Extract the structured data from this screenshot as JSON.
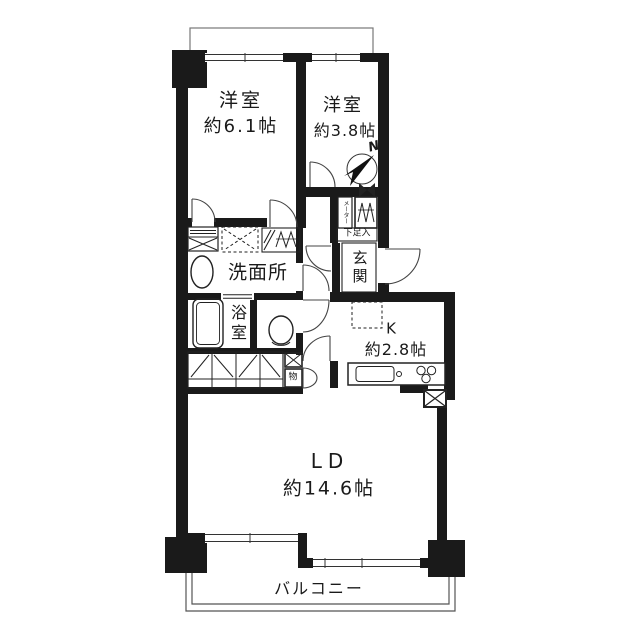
{
  "labels": {
    "bedroom1_name": "洋室",
    "bedroom1_size": "約6.1帖",
    "bedroom2_name": "洋室",
    "bedroom2_size": "約3.8帖",
    "washroom": "洗面所",
    "bath": "浴室",
    "entrance": "玄関",
    "shoe_cabinet": "下足入",
    "meter_box": "メーター",
    "storage": "物",
    "kitchen_name": "K",
    "kitchen_size": "約2.8帖",
    "living_dining_name": "LD",
    "living_dining_size": "約14.6帖",
    "balcony": "バルコニー",
    "compass_north": "N"
  },
  "colors": {
    "wall": "#1a1a1a",
    "line": "#444444",
    "background": "#ffffff"
  }
}
